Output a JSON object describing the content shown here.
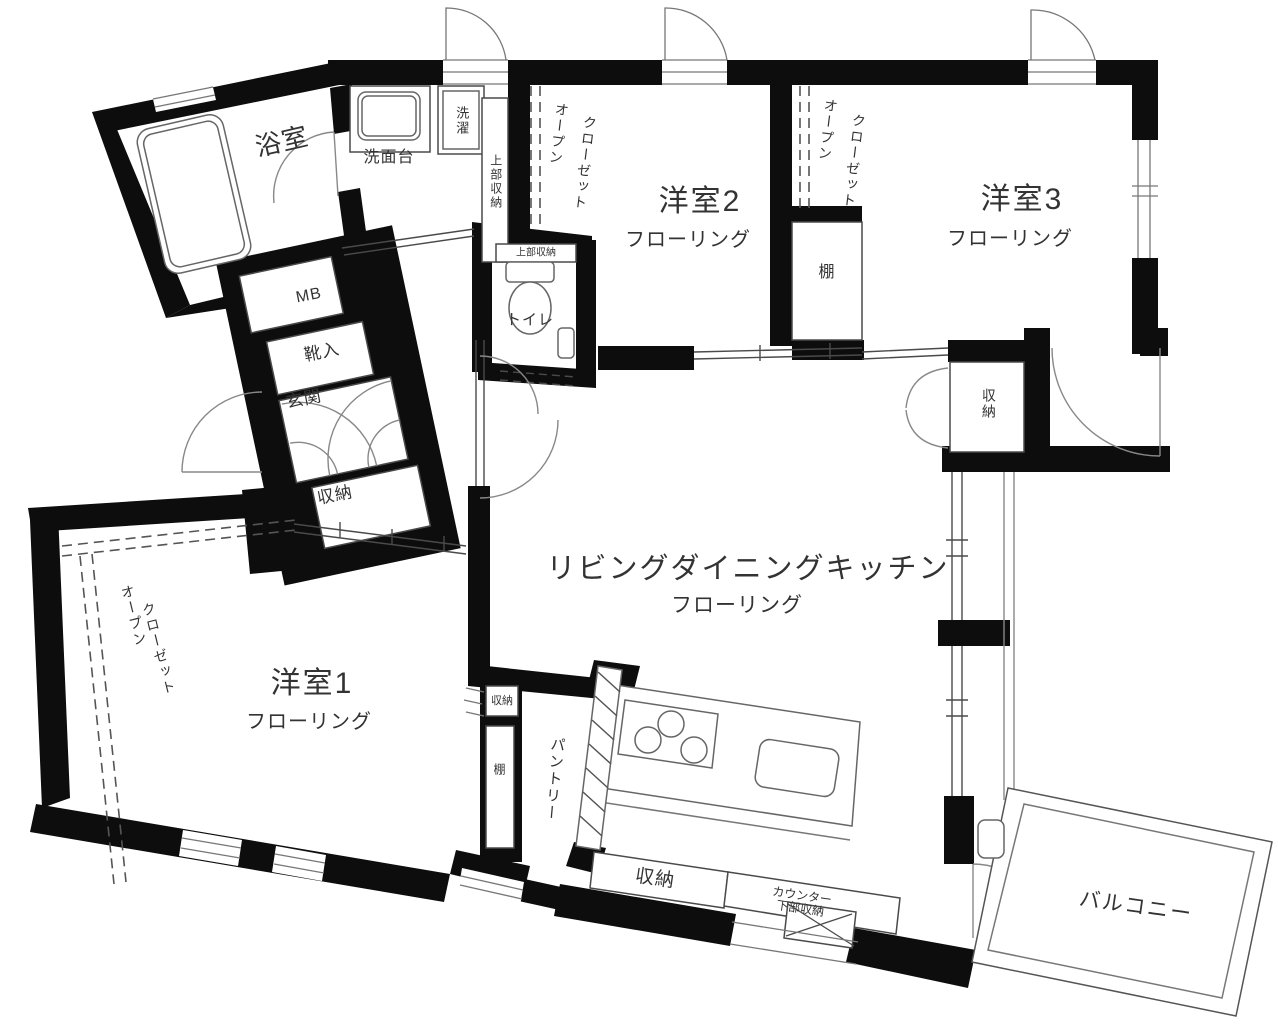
{
  "plan": {
    "labels": {
      "bathroom": "浴室",
      "vanity": "洗面台",
      "washer": "洗濯",
      "upper_storage": "上部収納",
      "open_closet": {
        "line1": "オープン",
        "line2": "クローゼット"
      },
      "room1": "洋室1",
      "room2": "洋室2",
      "room3": "洋室3",
      "flooring": "フローリング",
      "shelf": "棚",
      "mb": "MB",
      "shoe_box": "靴入",
      "entrance": "玄関",
      "storage": "収納",
      "toilet": "トイレ",
      "ldk": "リビングダイニングキッチン",
      "pantry": "パントリー",
      "counter_storage": {
        "line1": "カウンター",
        "line2": "下部収納"
      },
      "balcony": "バルコニー"
    },
    "colors": {
      "wall": "#0d0d0d",
      "line": "#555555",
      "text": "#333333"
    }
  }
}
